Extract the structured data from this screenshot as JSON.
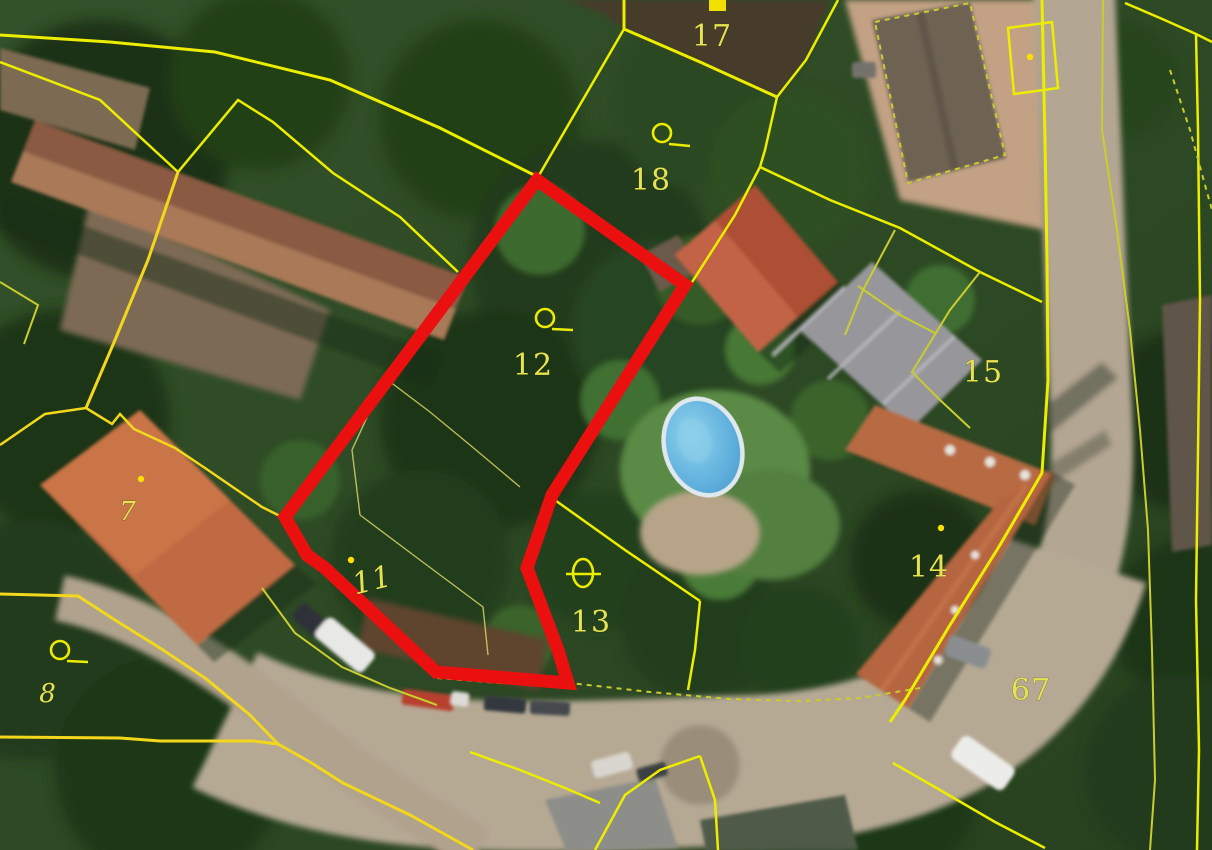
{
  "map": {
    "type": "cadastral-parcel-overlay-on-orthophoto",
    "highlighted_parcel": "12",
    "parcel_labels": {
      "p17": "17",
      "p18": "18",
      "p12": "12",
      "p15": "15",
      "p7": "7",
      "p11": "11",
      "p13": "13",
      "p14": "14",
      "p8": "8",
      "p67": "67"
    },
    "symbols": [
      {
        "name": "orchard-symbol",
        "near_parcel": "18"
      },
      {
        "name": "orchard-symbol",
        "near_parcel": "12"
      },
      {
        "name": "orchard-symbol",
        "near_parcel": "8"
      },
      {
        "name": "building-symbol",
        "near_parcel": "13"
      },
      {
        "name": "parcel-point",
        "near_parcel": "7"
      },
      {
        "name": "parcel-point",
        "near_parcel": "11"
      },
      {
        "name": "parcel-point",
        "near_parcel": "14"
      },
      {
        "name": "boundary-marker-square",
        "near_parcel": "17"
      }
    ],
    "colors": {
      "parcel_boundary": "#eded00",
      "parcel_boundary_dim": "#c9cd2e",
      "highlight_outline": "#ea1010",
      "label_text": "#e6e353",
      "road_surface": "#b6a994",
      "pool_water": "#5fb0dd"
    }
  }
}
